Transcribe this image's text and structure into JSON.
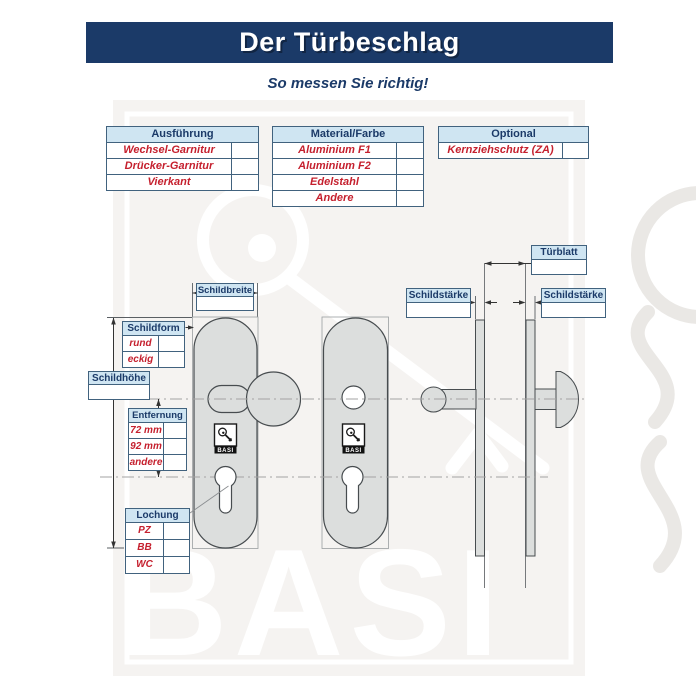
{
  "header": {
    "title": "Der Türbeschlag",
    "subtitle": "So messen Sie richtig!"
  },
  "option_tables": {
    "ausfuehrung": {
      "title": "Ausführung",
      "rows": [
        {
          "label": "Wechsel-Garnitur"
        },
        {
          "label": "Drücker-Garnitur"
        },
        {
          "label": "Vierkant"
        }
      ]
    },
    "material": {
      "title": "Material/Farbe",
      "rows": [
        {
          "label": "Aluminium F1"
        },
        {
          "label": "Aluminium F2"
        },
        {
          "label": "Edelstahl"
        },
        {
          "label": "Andere"
        }
      ]
    },
    "optional": {
      "title": "Optional",
      "rows": [
        {
          "label": "Kernziehschutz (ZA)"
        }
      ]
    }
  },
  "measure_tables": {
    "schildform": {
      "title": "Schildform",
      "rows": [
        {
          "label": "rund"
        },
        {
          "label": "eckig"
        }
      ]
    },
    "entfernung": {
      "title": "Entfernung",
      "rows": [
        {
          "label": "72 mm"
        },
        {
          "label": "92 mm"
        },
        {
          "label": "andere"
        }
      ]
    },
    "lochung": {
      "title": "Lochung",
      "rows": [
        {
          "label": "PZ"
        },
        {
          "label": "BB"
        },
        {
          "label": "WC"
        }
      ]
    }
  },
  "measure_labels": {
    "schildbreite": "Schildbreite",
    "schildhoehe": "Schildhöhe",
    "tuerblatt": "Türblatt",
    "schildstaerke_left": "Schildstärke",
    "schildstaerke_right": "Schildstärke"
  },
  "brand": {
    "watermark_text": "BASI",
    "badge_text": "BASI"
  },
  "colors": {
    "banner_navy": "#1b3a68",
    "table_header_blue": "#cfe5f2",
    "accent_red": "#c5202e",
    "table_border": "#41627e",
    "plate_gray": "#dcdedd"
  }
}
